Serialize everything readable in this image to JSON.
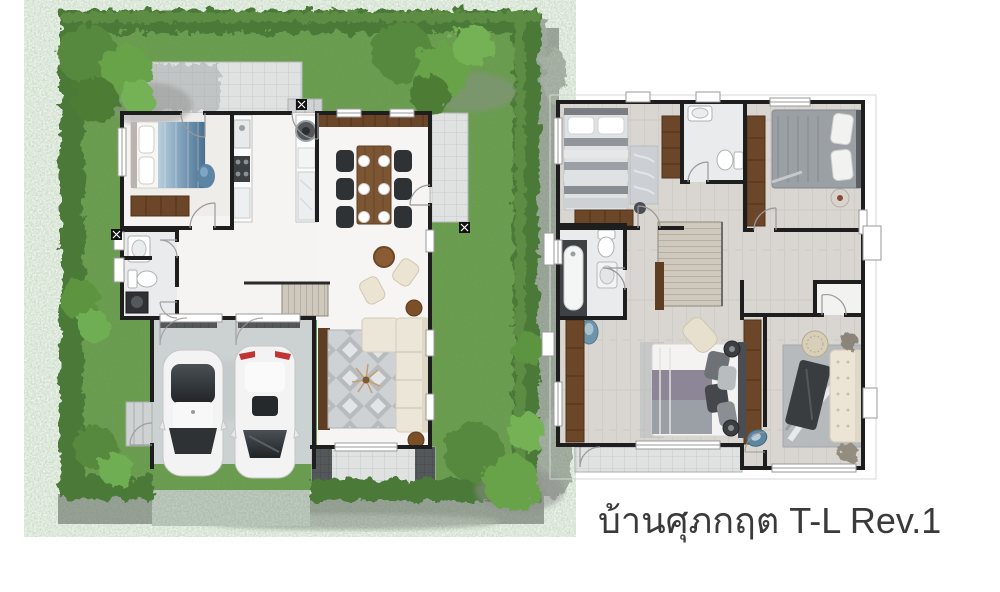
{
  "caption": {
    "text": "บ้านศุภกฤต T-L Rev.1"
  },
  "palette": {
    "grass": "#6f9f50",
    "hedge": "#4c7a38",
    "tree": "#5f963f",
    "tree_light": "#7cbd5e",
    "sidewalk": "#a3a3a3",
    "driveway": "#ced1d1",
    "wall": "#1e1e1e",
    "floor_white": "#f5f4f2",
    "floor_planks": "#d9d6d1",
    "tile": "#e0e2e2",
    "wood_dark": "#6b4629",
    "wood_table": "#7c5633",
    "sofa_cream": "#ece4d4",
    "rug_gray": "#bfc3c5",
    "car_body": "#f3f3f3",
    "tail_light_red": "#c23434",
    "water_blue": "#6f93a8",
    "caption_color": "#3a3a3a"
  },
  "plans": [
    {
      "id": "ground-floor",
      "rooms": [
        "bedroom",
        "bathroom",
        "kitchen",
        "dining",
        "living",
        "stairs",
        "garage",
        "front-terrace",
        "side-terrace",
        "service-yard",
        "garden"
      ],
      "furniture": [
        "double-bed",
        "wardrobe",
        "washbasin",
        "toilet",
        "washing-machine",
        "kitchen-counters",
        "stove",
        "dining-table-6-chairs",
        "coffee-table",
        "lounge-chairs",
        "sofa",
        "rug",
        "tv-console",
        "car",
        "car"
      ]
    },
    {
      "id": "second-floor",
      "rooms": [
        "bedroom-2",
        "bathroom-2",
        "bedroom-3",
        "bathroom-3",
        "hall",
        "stairs",
        "master-bedroom",
        "family-room",
        "balcony"
      ],
      "furniture": [
        "single-bed",
        "rug",
        "dresser",
        "wardrobes",
        "bathtub",
        "toilet",
        "washbasin",
        "double-bed",
        "chaise",
        "sofa",
        "coffee-table",
        "rattan-pouf",
        "plants"
      ]
    }
  ]
}
